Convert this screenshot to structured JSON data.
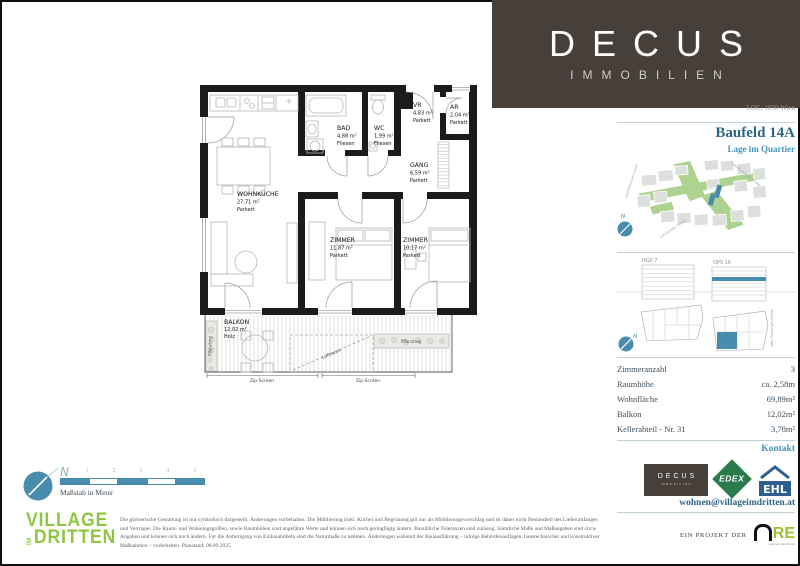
{
  "brand": {
    "word": "DECUS",
    "sub": "IMMOBILIEN",
    "box_color": "#473f3a"
  },
  "sidebar": {
    "address": "3.OG, 1030 Wien",
    "title": "Baufeld 14A",
    "subtitle": "Lage im Quartier",
    "map": {
      "street_left": "Adolf-Blamauer-Gasse",
      "street_top": "Otto-Preminger-Straße",
      "street_bottom": "Landstraßer Gürtel",
      "compass": "N"
    },
    "sections": {
      "left_label": "HGP 7",
      "right_label": "OPS 16",
      "street": "Otto-Preminger-Straße",
      "compass": "N"
    },
    "details": [
      {
        "label": "Zimmeranzahl",
        "value": "3"
      },
      {
        "label": "Raumhöhe",
        "value": "ca. 2,58m"
      },
      {
        "label": "Wohnfläche",
        "value": "69,89m²"
      },
      {
        "label": "Balkon",
        "value": "12,02m²"
      },
      {
        "label": "Kellerabteil - Nr. 31",
        "value": "3,78m²"
      }
    ],
    "kontakt": {
      "heading": "Kontakt",
      "email": "wohnen@villageimdritten.at",
      "logo_decus": "DECUS",
      "logo_decus_sub": "IMMOBILIEN",
      "logo_edex": "EDEX",
      "logo_ehl": "EHL"
    },
    "project": {
      "prefix": "EIN PROJEKT DER",
      "are_word": "RE",
      "are_sub": "Austrian Real Estate"
    }
  },
  "floorplan": {
    "rooms": [
      {
        "name": "WOHNKÜCHE",
        "area": "27,71 m²",
        "floor": "Parkett"
      },
      {
        "name": "BAD",
        "area": "4,88 m²",
        "floor": "Fliesen"
      },
      {
        "name": "WC",
        "area": "1,99 m²",
        "floor": "Fliesen"
      },
      {
        "name": "VR",
        "area": "4,83 m²",
        "floor": "Parkett"
      },
      {
        "name": "AR",
        "area": "2,04 m²",
        "floor": "Parkett"
      },
      {
        "name": "GANG",
        "area": "6,59 m²",
        "floor": "Parkett"
      },
      {
        "name": "ZIMMER",
        "area": "11,87 m²",
        "floor": "Parkett"
      },
      {
        "name": "ZIMMER",
        "area": "10,17 m²",
        "floor": "Parkett"
      },
      {
        "name": "BALKON",
        "area": "12,02 m²",
        "floor": "Holz"
      }
    ],
    "annotations": {
      "pflanztrog_left": "Pflanztrog",
      "pflanztrog_right": "Pflanztrog",
      "luftraum": "Luftraum",
      "zip_screen_1": "Zip-Screen",
      "zip_screen_2": "Zip-Screen"
    }
  },
  "scalebar": {
    "label": "Maßstab in Meter",
    "ticks": [
      "1",
      "2",
      "3",
      "4",
      "5"
    ],
    "compass": "N"
  },
  "village_logo": {
    "line1": "VILLAGE",
    "im": "IM",
    "line2": "DRITTEN"
  },
  "disclaimer": "Die gärtnerische Gestaltung ist nur symbolisch dargestellt. Änderungen vorbehalten. Die Möblierung (inkl. Küche) und Begrünung gilt nur als Möblierungsvorschlag und ist daher nicht Bestandteil des Lieferumfanges und Vertrages. Die Raum- und Wohnungsgrößen, sowie Raumhöhen sind ungefähre Werte und können sich noch geringfügig ändern. Bauübliche Toleranzen sind zulässig. Sämtliche Maße und Maßangaben sind circa-Angaben und können sich noch ändern. Für die Anfertigung von Einbaumöbeln sind die Naturmaße zu nehmen. Änderungen während der Bauausführung – infolge Behördenauflagen, haustechnischer und konstruktiver Maßnahmen – vorbehalten. Planstand: 08.09.2025"
}
